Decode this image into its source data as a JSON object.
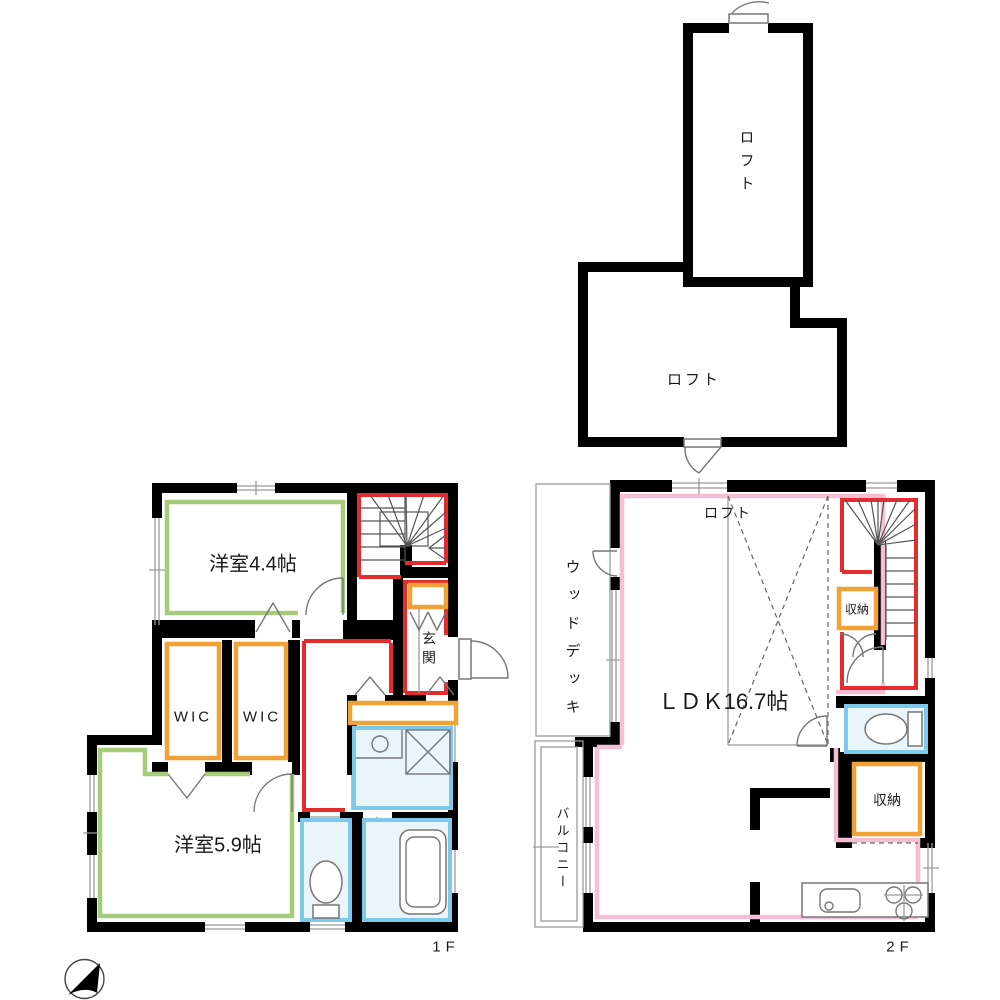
{
  "colors": {
    "wall": "#000000",
    "green": "#a5cb7d",
    "orange": "#f0a236",
    "red": "#e62b2f",
    "blue": "#7ec8ea",
    "bluefill": "#e9f4fb",
    "pink": "#f5bed4"
  },
  "labels": {
    "loft_upper": "ロフト",
    "loft_lower": "ロフト",
    "room_4_4": "洋室4.4帖",
    "wic_left": "WIC",
    "wic_right": "WIC",
    "genkan": "玄関",
    "room_5_9": "洋室5.9帖",
    "floor1": "1F",
    "wood_deck": "ウッドデッキ",
    "balcony": "バルコニー",
    "loft_mark": "ロフト",
    "ldk": "ＬＤＫ16.7帖",
    "storage_upper": "収納",
    "storage_lower": "収納",
    "floor2": "2F"
  }
}
